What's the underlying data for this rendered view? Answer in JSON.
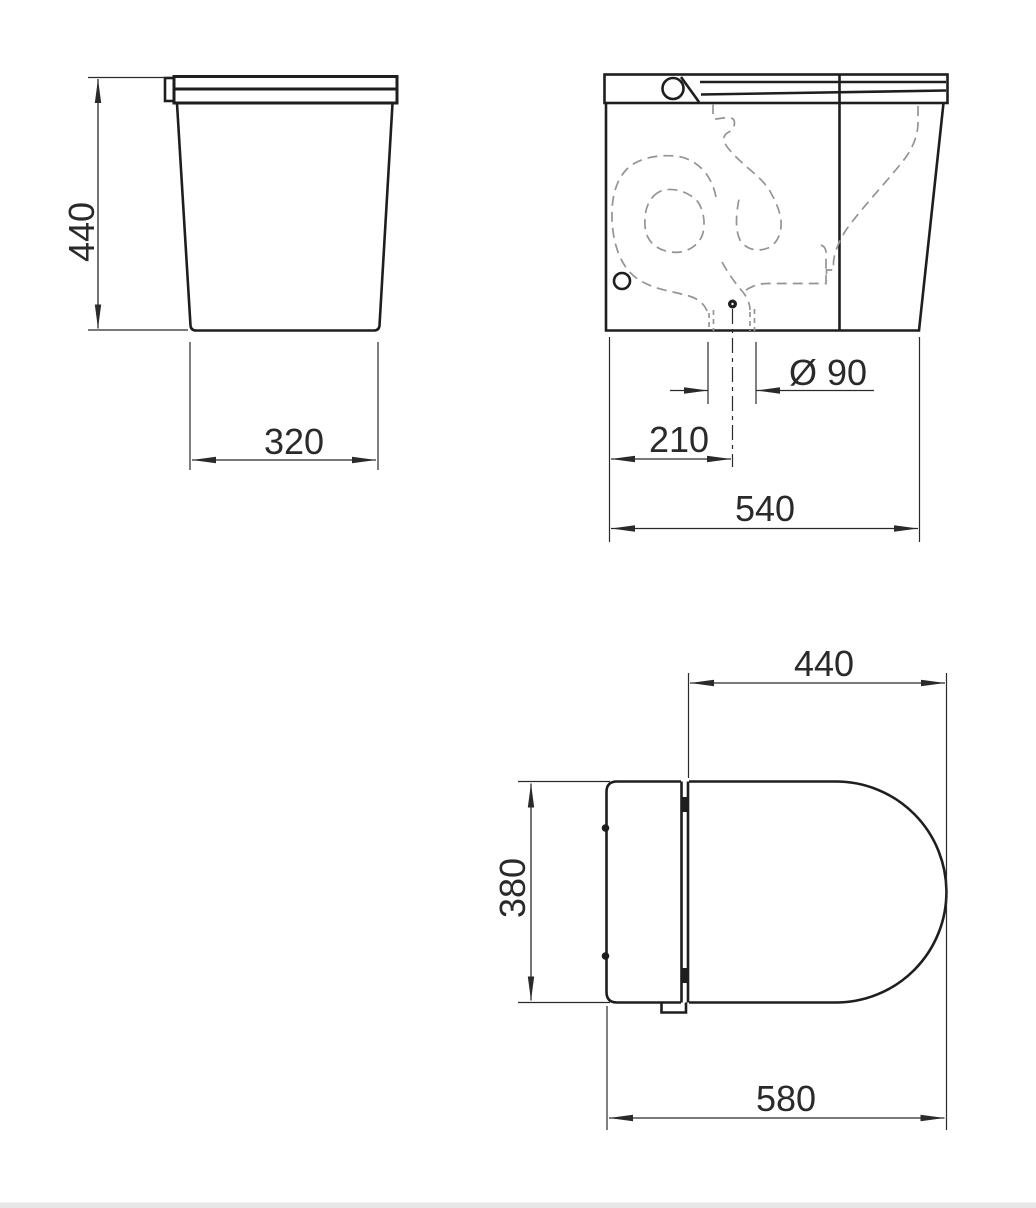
{
  "colors": {
    "line": "#1e1e1e",
    "dashed": "#949494",
    "dim_text": "#2a2a2a",
    "footer_bar": "#e7e7e7",
    "paper": "#ffffff"
  },
  "views": {
    "front": {
      "height": "440",
      "base_width": "320"
    },
    "side": {
      "outlet_diameter": "Ø 90",
      "outlet_offset": "210",
      "depth": "540"
    },
    "top": {
      "lid_length": "440",
      "width": "380",
      "length": "580"
    }
  }
}
